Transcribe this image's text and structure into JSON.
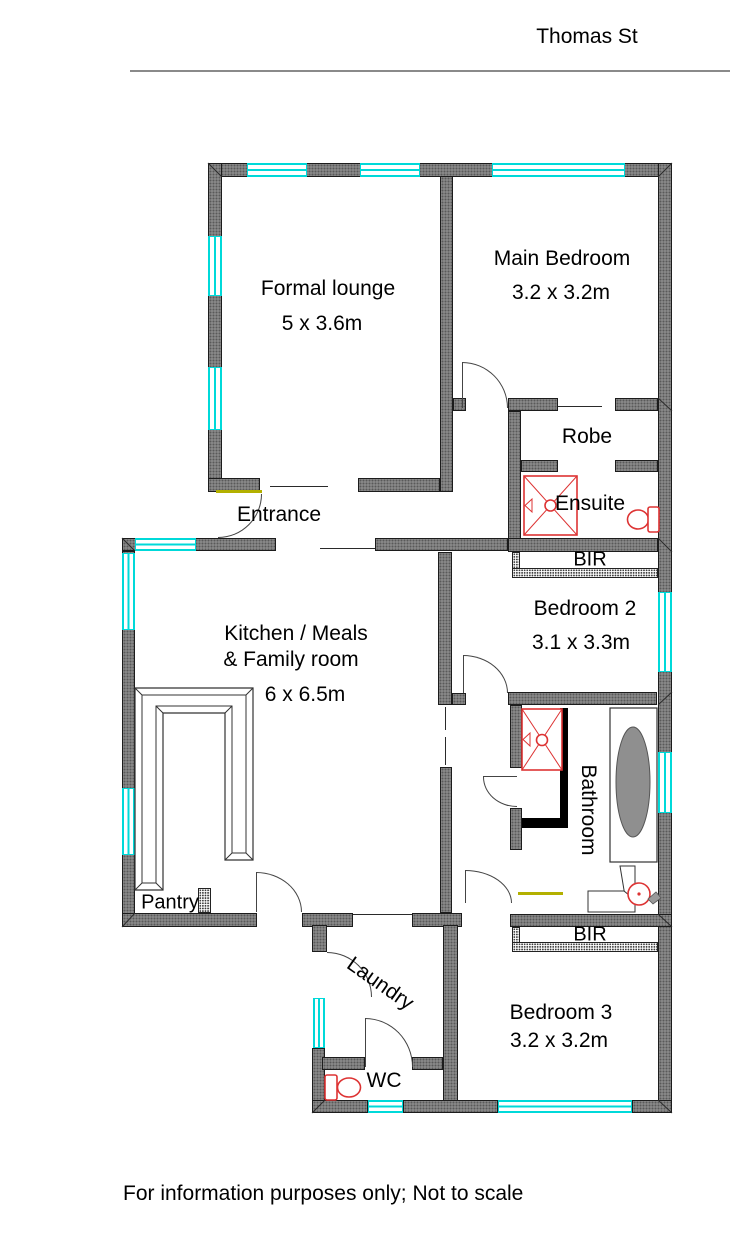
{
  "header": {
    "street": "Thomas St"
  },
  "rooms": {
    "formal_lounge": {
      "name": "Formal lounge",
      "dims": "5 x 3.6m"
    },
    "main_bedroom": {
      "name": "Main Bedroom",
      "dims": "3.2 x 3.2m"
    },
    "robe": {
      "name": "Robe"
    },
    "ensuite": {
      "name": "Ensuite"
    },
    "bir_ensuite": {
      "name": "BIR"
    },
    "bedroom_2": {
      "name": "Bedroom 2",
      "dims": "3.1 x 3.3m"
    },
    "entrance": {
      "name": "Entrance"
    },
    "kitchen": {
      "name": "Kitchen / Meals",
      "name2": "& Family room",
      "dims": "6 x 6.5m"
    },
    "bathroom": {
      "name": "Bathroom"
    },
    "pantry": {
      "name": "Pantry"
    },
    "laundry": {
      "name": "Laundry"
    },
    "bir_bedroom3": {
      "name": "BIR"
    },
    "bedroom_3": {
      "name": "Bedroom 3",
      "dims": "3.2 x 3.2m"
    },
    "wc": {
      "name": "WC"
    }
  },
  "footer": {
    "disclaimer": "For information purposes only; Not to scale"
  },
  "colors": {
    "wall": "#8f8f8f",
    "window": "#00d9d9",
    "fixture": "#dd3333",
    "threshold": "#b3b000"
  }
}
